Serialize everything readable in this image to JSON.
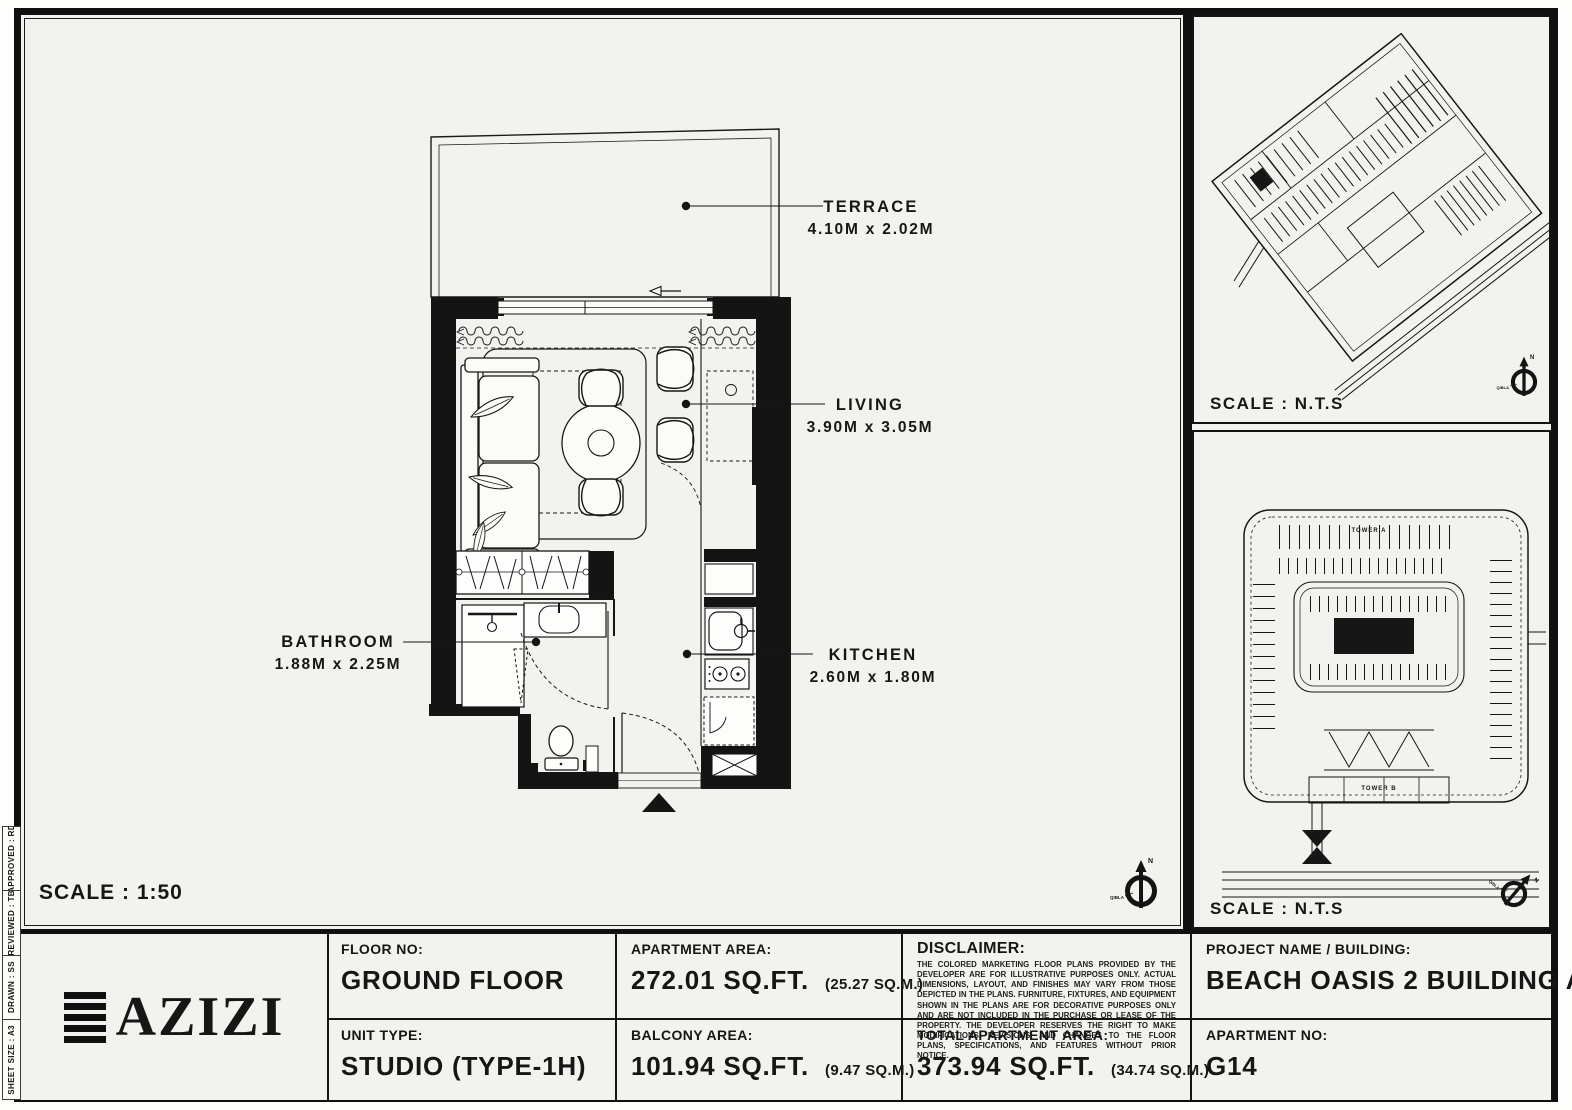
{
  "colors": {
    "paper": "#f2f2ee",
    "ink": "#161616"
  },
  "plan": {
    "scale_label": "SCALE : 1:50",
    "rooms": [
      {
        "name": "TERRACE",
        "dims": "4.10M x 2.02M"
      },
      {
        "name": "LIVING",
        "dims": "3.90M x 3.05M"
      },
      {
        "name": "BATHROOM",
        "dims": "1.88M x 2.25M"
      },
      {
        "name": "KITCHEN",
        "dims": "2.60M x 1.80M"
      }
    ]
  },
  "compass": {
    "north": "N",
    "qibla": "QIBLA"
  },
  "site_map": {
    "scale_label": "SCALE : N.T.S"
  },
  "master_plan": {
    "scale_label": "SCALE : N.T.S",
    "tower_a": "TOWER A",
    "tower_b": "TOWER B"
  },
  "sheet_strip": {
    "items": [
      "APPROVED :  RD",
      "REVIEWED :  TB",
      "DRAWN :  SS",
      "SHEET SIZE : A3"
    ]
  },
  "title_block": {
    "logo_text": "AZIZI",
    "floor": {
      "label": "FLOOR NO:",
      "value": "GROUND FLOOR"
    },
    "unit_type": {
      "label": "UNIT TYPE:",
      "value": "STUDIO (TYPE-1H)"
    },
    "apartment_area": {
      "label": "APARTMENT AREA:",
      "value": "272.01 SQ.FT.",
      "metric": "(25.27 SQ.M.)"
    },
    "balcony_area": {
      "label": "BALCONY AREA:",
      "value": "101.94 SQ.FT.",
      "metric": "(9.47 SQ.M.)"
    },
    "disclaimer": {
      "label": "DISCLAIMER:",
      "body": "THE COLORED MARKETING FLOOR PLANS PROVIDED BY THE DEVELOPER ARE FOR ILLUSTRATIVE PURPOSES ONLY. ACTUAL DIMENSIONS, LAYOUT, AND FINISHES MAY VARY FROM THOSE DEPICTED IN THE PLANS. FURNITURE, FIXTURES, AND EQUIPMENT SHOWN IN THE PLANS ARE FOR DECORATIVE PURPOSES ONLY AND ARE NOT INCLUDED IN THE PURCHASE OR LEASE OF THE PROPERTY. THE DEVELOPER RESERVES THE RIGHT TO MAKE MODIFICATIONS, REVISIONS, AND CHANGES TO THE FLOOR PLANS, SPECIFICATIONS, AND FEATURES WITHOUT PRIOR NOTICE."
    },
    "total_area": {
      "label": "TOTAL APARTMENT AREA:",
      "value": "373.94 SQ.FT.",
      "metric": "(34.74 SQ.M.)"
    },
    "project": {
      "label": "PROJECT NAME / BUILDING:",
      "value": "BEACH OASIS 2 BUILDING A"
    },
    "apartment_no": {
      "label": "APARTMENT NO:",
      "value": "G14"
    }
  }
}
